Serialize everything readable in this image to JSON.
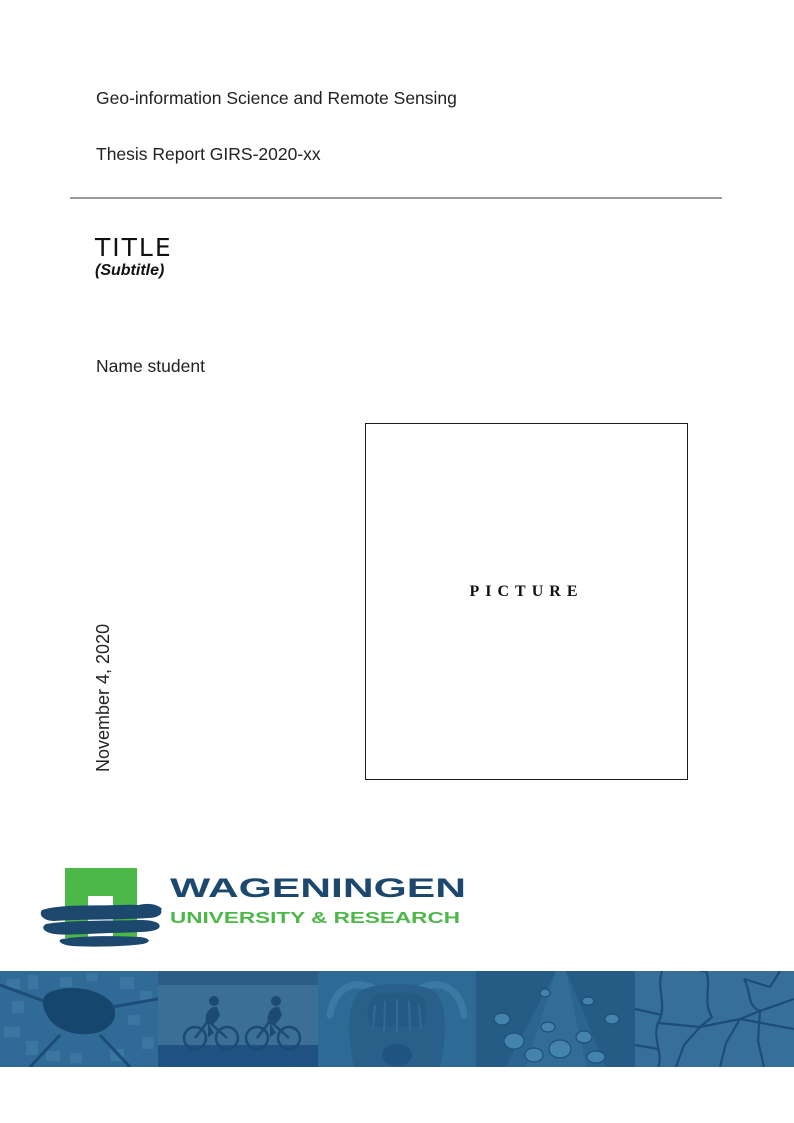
{
  "header": {
    "department": "Geo-information Science and Remote Sensing",
    "report": "Thesis Report GIRS-2020-xx"
  },
  "titleblock": {
    "title": "TITLE",
    "subtitle": "(Subtitle)"
  },
  "author": "Name student",
  "date": "November 4, 2020",
  "picture": {
    "placeholder": "PICTURE"
  },
  "logo": {
    "wordmark": "WAGENINGEN",
    "tagline": "UNIVERSITY & RESEARCH",
    "colors": {
      "green": "#4CB848",
      "navy": "#1D486E"
    }
  },
  "banner": {
    "tint": "#2E6C97",
    "images": [
      {
        "name": "aerial-map"
      },
      {
        "name": "cyclists"
      },
      {
        "name": "highland-cow"
      },
      {
        "name": "leaf-water-droplets"
      },
      {
        "name": "cracked-earth"
      }
    ]
  }
}
